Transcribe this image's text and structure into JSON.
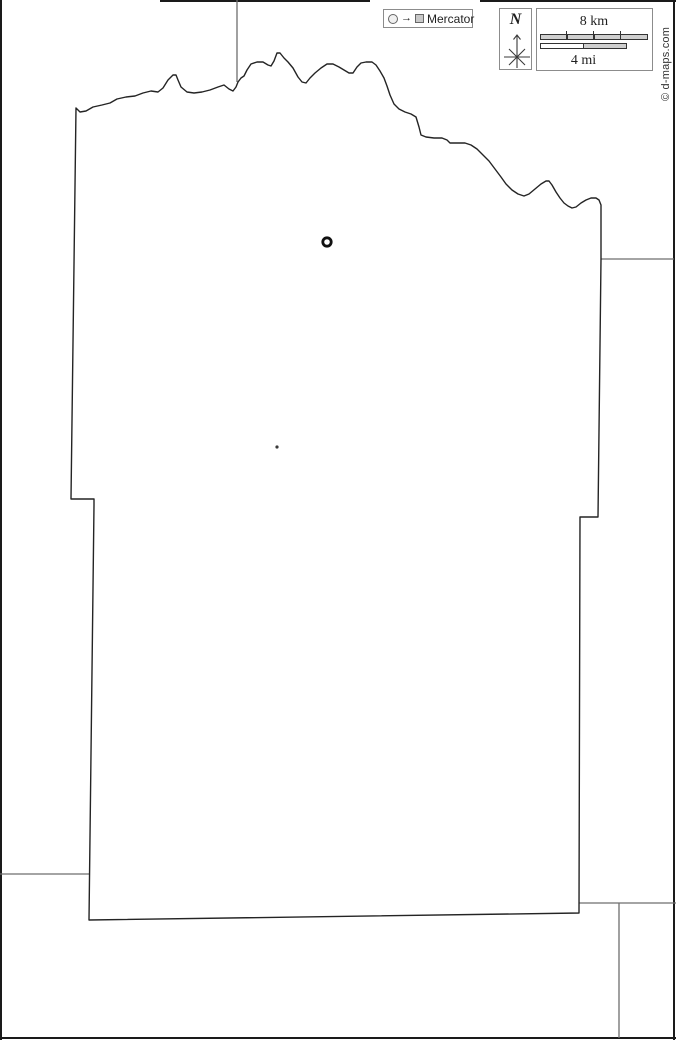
{
  "window": {
    "width": 676,
    "height": 1040
  },
  "projection_note": {
    "circle_icon": "city-circle-icon",
    "arrow": "→",
    "square_icon": "city-square-icon",
    "label": "Mercator"
  },
  "compass": {
    "label": "N"
  },
  "scale_bar": {
    "km_label": "8 km",
    "mi_label": "4 mi",
    "km_segments": 4,
    "mi_segments": 2
  },
  "credit": {
    "text": "© d-maps.com"
  },
  "theme": {
    "page-bg": "#ffffff",
    "outline": "#242424",
    "neighbor-line": "#6e6e6e",
    "frame-line": "#1a1a1a",
    "box-border": "#8c8c8c",
    "bar-fill": "#cfcfcf",
    "bar-border": "#333333",
    "icon-stroke": "#666666",
    "icon-circle-fill": "#f0f0f0",
    "icon-square-fill": "#c8c8c8",
    "text": "#1f1f1f",
    "credit-text": "#333333",
    "marker": "#111111",
    "marker-dot": "#3a3a3a"
  },
  "map_geometry": {
    "county_outline": "M76,108 L80,112 86,111 93,107 102,105 110,103 117,99 126,97 135,96 143,93 151,91 158,92 163,88 168,80 173,75 176,75 178,80 181,87 187,92 194,93 202,92 210,90 218,87 224,85 229,89 233,91 236,87 238,82 241,78 244,76 247,70 251,64 257,62 263,62 268,65 271,66 274,61 277,53 280,53 284,58 288,62 293,68 298,77 302,82 306,83 310,78 315,73 321,68 327,64 333,64 339,67 344,70 349,73 353,73 357,67 361,63 366,62 372,62 376,65 380,71 384,78 387,86 390,95 394,104 399,109 405,112 411,114 416,117 419,127 421,135 426,137 434,138 442,138 447,140 450,143 457,143 465,143 471,145 477,149 483,155 489,161 495,169 501,177 506,184 512,190 518,194 524,196 529,194 535,189 541,184 546,181 549,181 552,185 556,192 560,198 564,203 568,206 572,208 576,207 581,203 586,200 591,198 596,198 599,200 601,205 601,211 601,259 598,517 580,517 579,913 89,920 94,505 94,499 71,499 Z",
    "neighbor_lines": "M237,0 L237,82 M601,259 L674,259 M0,874 L89,874 M579,903 L676,903 M619,903 L619,1038",
    "frame_lines": "M1,0 L1,1040 M674,0 L674,1040 M0,1038 L676,1038 M160,1 L370,1 M480,1 L676,1",
    "markers": {
      "town_ring": {
        "cx": 327,
        "cy": 242,
        "r": 4.2
      },
      "locality_dot": {
        "cx": 277,
        "cy": 447,
        "r": 1.6
      }
    }
  }
}
